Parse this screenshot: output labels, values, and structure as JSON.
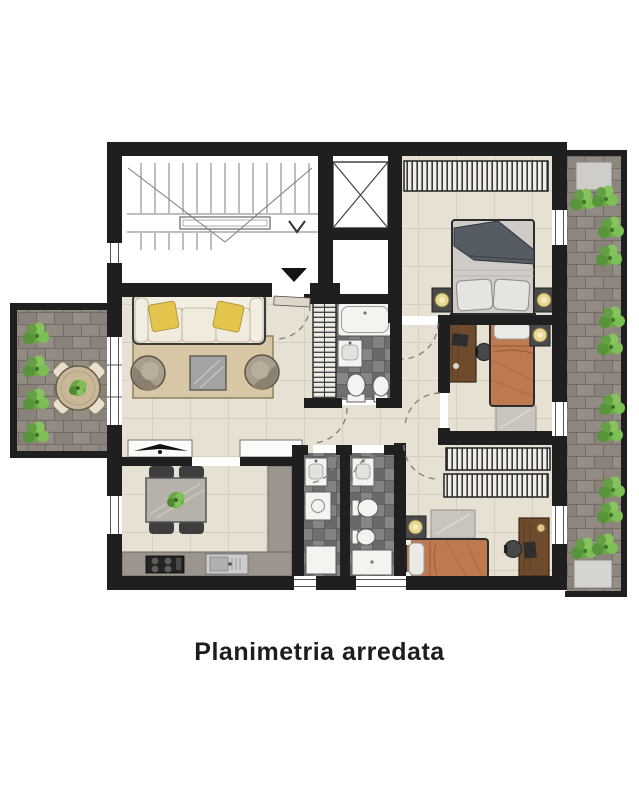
{
  "title": "Planimetria arredata",
  "plan": {
    "kind": "furnished-floor-plan",
    "rooms": [
      "stairwell",
      "elevator",
      "entry-hall",
      "living-room",
      "dining-kitchen",
      "bathroom-main",
      "laundry-room",
      "bathroom-second",
      "corridor",
      "bedroom-master",
      "bedroom-middle",
      "bedroom-bottom",
      "left-terrace",
      "right-terrace"
    ],
    "furniture": {
      "living_room": [
        "sofa",
        "yellow-pillows",
        "rug",
        "coffee-table",
        "armchair",
        "armchair",
        "tv-console",
        "sideboard"
      ],
      "dining_kitchen": [
        "dining-table",
        "chairs-4",
        "plant",
        "kitchen-counter",
        "stove",
        "sink"
      ],
      "bathroom_main": [
        "radiator",
        "bathtub",
        "sink",
        "toilet",
        "bidet"
      ],
      "laundry_room": [
        "sink",
        "washing-machine",
        "cabinet"
      ],
      "bathroom_second": [
        "sink",
        "toilet",
        "bidet",
        "shower-tray"
      ],
      "bedroom_master": [
        "wardrobe",
        "double-bed",
        "nightstand",
        "nightstand",
        "lamps"
      ],
      "bedroom_middle": [
        "desk",
        "chair",
        "single-bed",
        "rug",
        "nightstand"
      ],
      "bedroom_bottom": [
        "wardrobe",
        "wardrobe",
        "single-bed",
        "rug",
        "desk",
        "chair",
        "nightstand"
      ],
      "left_terrace": [
        "bushes-4",
        "round-table",
        "chairs-4",
        "plant"
      ],
      "right_terrace": [
        "storage-box",
        "storage-box",
        "bushes",
        "paving"
      ]
    }
  },
  "colors": {
    "background": "#ffffff",
    "wall": "#1f1f1f",
    "floor": "#e7e1d3",
    "floor_line": "#d6cfbf",
    "paving": "#8c867e",
    "plant_green": "#6da744",
    "sofa_cream": "#efe8da",
    "pillow_yellow": "#e3c44d",
    "bed_gray": "#cfccc7",
    "bed_orange": "#bf7950",
    "wood": "#6f4b2e",
    "counter_gray": "#9b958d",
    "rug_tan": "#d7c7a4",
    "fixture_white": "#f4f3f0",
    "caption": "#1d1d1d"
  }
}
